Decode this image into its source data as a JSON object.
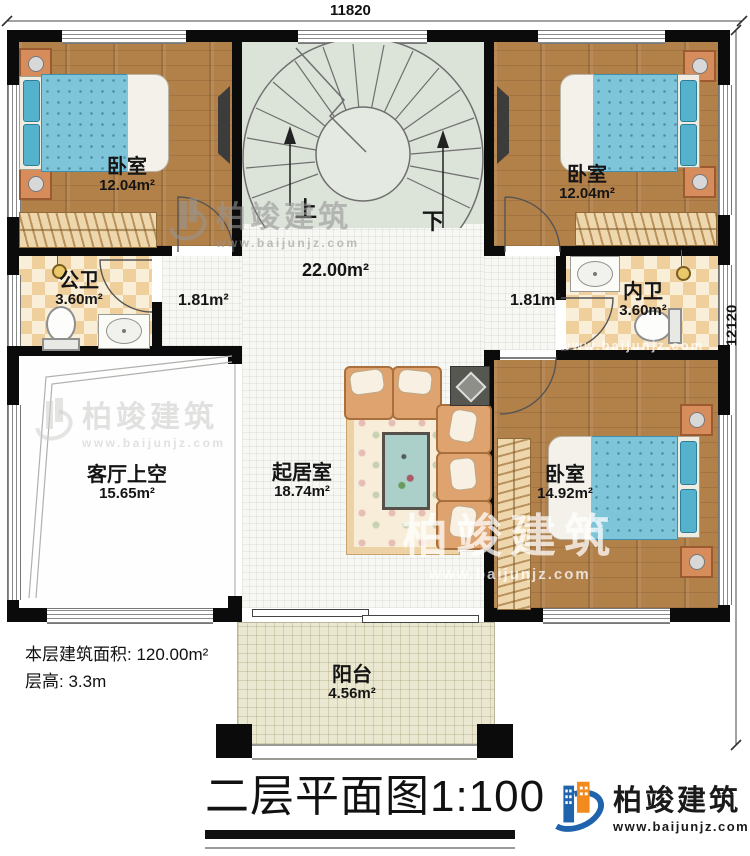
{
  "dimensions": {
    "width_top": "11820",
    "height_right": "12120"
  },
  "stair": {
    "up_label": "上",
    "down_label": "下"
  },
  "rooms": {
    "bedroom_top_left": {
      "name": "卧室",
      "area": "12.04m²"
    },
    "bedroom_top_right": {
      "name": "卧室",
      "area": "12.04m²"
    },
    "bedroom_bottom_right": {
      "name": "卧室",
      "area": "14.92m²"
    },
    "public_bathroom": {
      "name": "公卫",
      "area": "3.60m²"
    },
    "ensuite_bathroom": {
      "name": "内卫",
      "area": "3.60m²"
    },
    "living_void": {
      "name": "客厅上空",
      "area": "15.65m²"
    },
    "family_room": {
      "name": "起居室",
      "area": "18.74m²"
    },
    "balcony": {
      "name": "阳台",
      "area": "4.56m²"
    },
    "hall": {
      "area": "22.00m²"
    },
    "corridor_left": {
      "area": "1.81m²"
    },
    "corridor_right": {
      "area": "1.81m²"
    }
  },
  "notes": {
    "floor_area": "本层建筑面积: 120.00m²",
    "floor_height": "层高: 3.3m"
  },
  "title": {
    "text": "二层平面图",
    "scale": "1:100"
  },
  "brand": {
    "name": "柏竣建筑",
    "website": "www.baijunjz.com"
  },
  "watermark": {
    "name": "柏竣建筑",
    "website": "www.baijunjz.com"
  },
  "colors": {
    "accent_blue": "#1f63ad",
    "accent_orange": "#f28a1d",
    "wall": "#0b0b0b"
  }
}
